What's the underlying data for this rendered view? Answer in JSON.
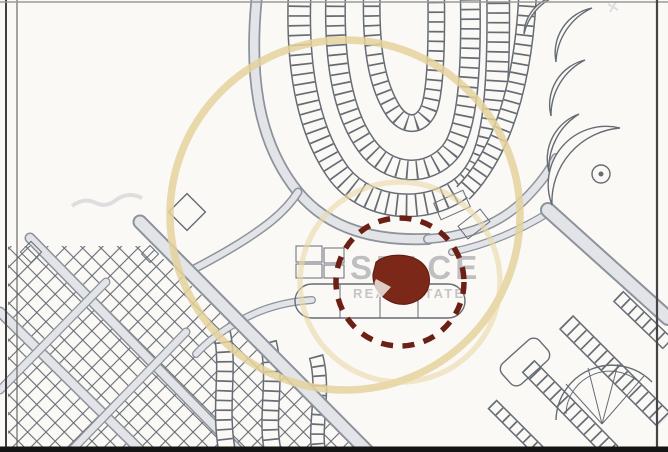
{
  "watermark": {
    "line1": "SPACE",
    "line2": "REAL ESTATE",
    "text_color": "#85858c",
    "ring_outer_color": "#e4d29c",
    "ring_inner_color": "#ead9a8"
  },
  "highlight": {
    "dashed_circle_color": "#6c1f15",
    "plot_fill_color": "#7c2818"
  },
  "map": {
    "paper_color": "#fbf9f6",
    "linework_color": "#666c74",
    "road_fill_color": "#e2e4e8",
    "frame_color": "#141414"
  }
}
